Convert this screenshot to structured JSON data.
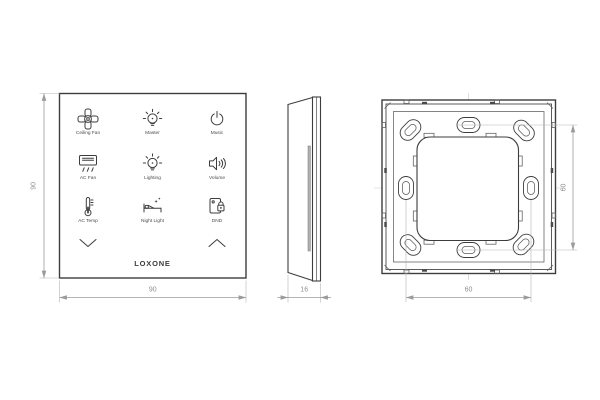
{
  "colors": {
    "line": "#3d3d3d",
    "dim_line": "#9b9b9b",
    "dim_text": "#8f8f8f",
    "background": "#ffffff"
  },
  "front_view": {
    "dim_height": "90",
    "dim_width": "90",
    "logo": "LOXONE",
    "buttons": [
      {
        "label": "Ceiling Fan",
        "icon": "ceiling-fan-icon"
      },
      {
        "label": "Master",
        "icon": "bulb-rays-icon"
      },
      {
        "label": "Music",
        "icon": "power-icon"
      },
      {
        "label": "AC Fan",
        "icon": "ac-unit-icon"
      },
      {
        "label": "Lighting",
        "icon": "bulb-rays-icon"
      },
      {
        "label": "Volume",
        "icon": "speaker-icon"
      },
      {
        "label": "AC Temp",
        "icon": "thermometer-icon"
      },
      {
        "label": "Night Light",
        "icon": "bed-icon"
      },
      {
        "label": "DND",
        "icon": "door-hanger-lock-icon"
      }
    ],
    "page_down_icon": "chevron-down-icon",
    "page_up_icon": "chevron-up-icon"
  },
  "side_view": {
    "dim_depth": "16"
  },
  "back_view": {
    "dim_hole_spacing_horizontal": "60",
    "dim_hole_spacing_vertical": "60"
  }
}
